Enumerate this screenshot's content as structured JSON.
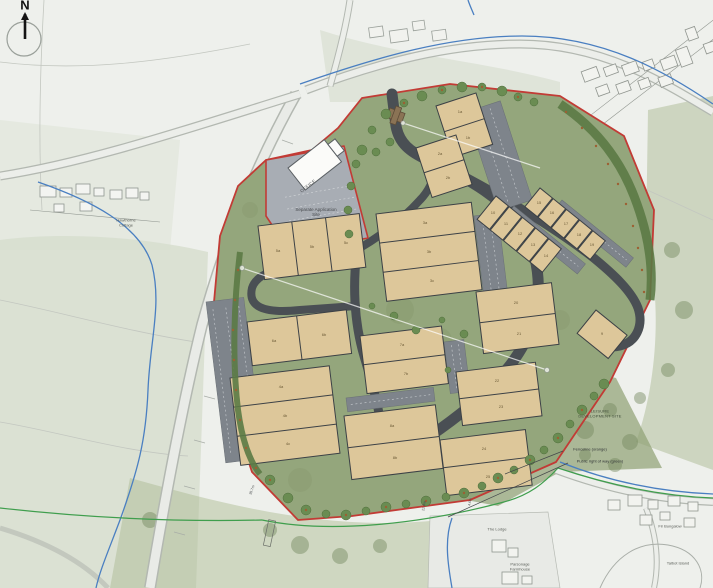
{
  "map": {
    "compass_label": "N",
    "labels": {
      "office": "OFFICE",
      "separate_application_site": "Separate Application Site",
      "leisure_line1": "LEISURE",
      "leisure_line2": "DEVELOPMENT SITE",
      "hawthorne_cottage": "Hawthorne Cottage",
      "the_lodge": "The Lodge",
      "parsonage_farmhouse": "Parsonage Farmhouse",
      "fir_bungalow": "Fir Bungalow",
      "talbot_island": "Talbot Island"
    },
    "legend": {
      "fenceline": "Fenceline (orange)",
      "public_right_of_way": "Public right of way (green)"
    },
    "dimensions": [
      "35.7m",
      "22.4m",
      "4.6m"
    ],
    "unit_labels": {
      "b1": [
        "1a",
        "1b"
      ],
      "b2": [
        "2a",
        "2b"
      ],
      "b3": [
        "3a",
        "3b",
        "3c"
      ],
      "b4": [
        "4a",
        "4b",
        "4c"
      ],
      "b5": [
        "5a",
        "5b",
        "5c"
      ],
      "b6": [
        "6a",
        "6b"
      ],
      "b7": [
        "7a",
        "7b"
      ],
      "b8": [
        "8a",
        "8b"
      ],
      "b9": "9",
      "terrace_west": [
        "10",
        "11",
        "12",
        "13",
        "14"
      ],
      "terrace_east": [
        "15",
        "16",
        "17",
        "18",
        "19"
      ],
      "b10": [
        "20",
        "21"
      ],
      "b11": [
        "22",
        "23"
      ],
      "b12": [
        "24",
        "25"
      ]
    },
    "colors": {
      "site_boundary_red": "#c23b35",
      "building_tan": "#ddc79a",
      "site_green": "#94a67c",
      "road_grey": "#4a4f54",
      "water_blue": "#4a7fc1",
      "prow_green": "#3f9e4d",
      "separate_site_grey": "#a8adb4"
    }
  }
}
